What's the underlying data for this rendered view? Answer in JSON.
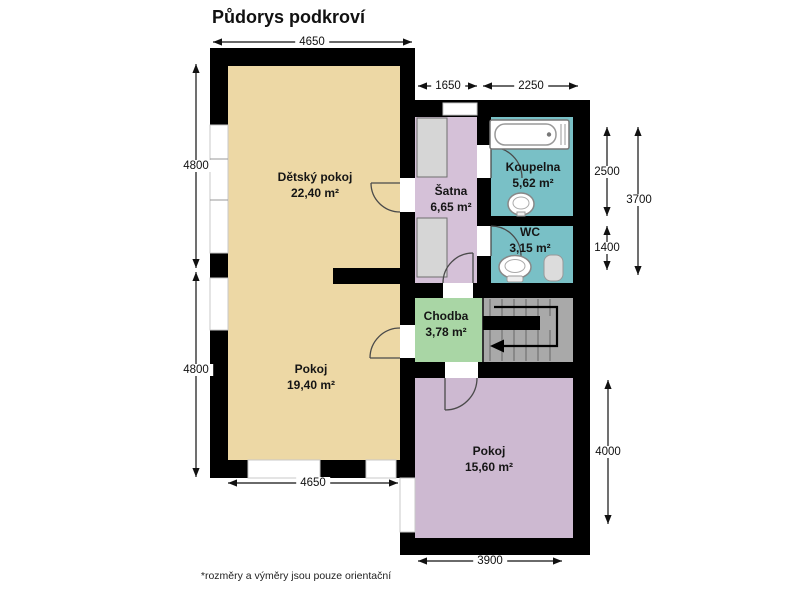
{
  "title": "Půdorys podkroví",
  "footnote": "*rozměry a výměry jsou pouze orientační",
  "rooms": {
    "detsky_pokoj": {
      "name": "Dětský pokoj",
      "area": "22,40 m²"
    },
    "satna": {
      "name": "Šatna",
      "area": "6,65 m²"
    },
    "koupelna": {
      "name": "Koupelna",
      "area": "5,62 m²"
    },
    "wc": {
      "name": "WC",
      "area": "3,15 m²"
    },
    "chodba": {
      "name": "Chodba",
      "area": "3,78 m²"
    },
    "pokoj_horni": {
      "name": "Pokoj",
      "area": "19,40 m²"
    },
    "pokoj_dolni": {
      "name": "Pokoj",
      "area": "15,60 m²"
    }
  },
  "dimensions": {
    "top": "4650",
    "top_satna": "1650",
    "top_koupelna": "2250",
    "left_upper": "4800",
    "left_lower": "4800",
    "right_koupelna": "2500",
    "right_wc": "1400",
    "right_total": "3700",
    "right_pokoj": "4000",
    "bottom_left": "4650",
    "bottom_right": "3900"
  },
  "colors": {
    "wall": "#000000",
    "room_beige": "#edd8a5",
    "room_lilac": "#d5c1d8",
    "room_teal": "#79c0c6",
    "room_green": "#a9d6a5",
    "room_mauve": "#cdb9d1",
    "stairs": "#a9a9a9",
    "wardrobe": "#d6d6d6"
  },
  "fixtures": {
    "bathtub": "bathtub",
    "sink": "washbasin",
    "toilet": "toilet",
    "wc_basin": "small-corner-basin",
    "stairs": "staircase-down-direction",
    "wardrobes": "built-in-wardrobe"
  }
}
